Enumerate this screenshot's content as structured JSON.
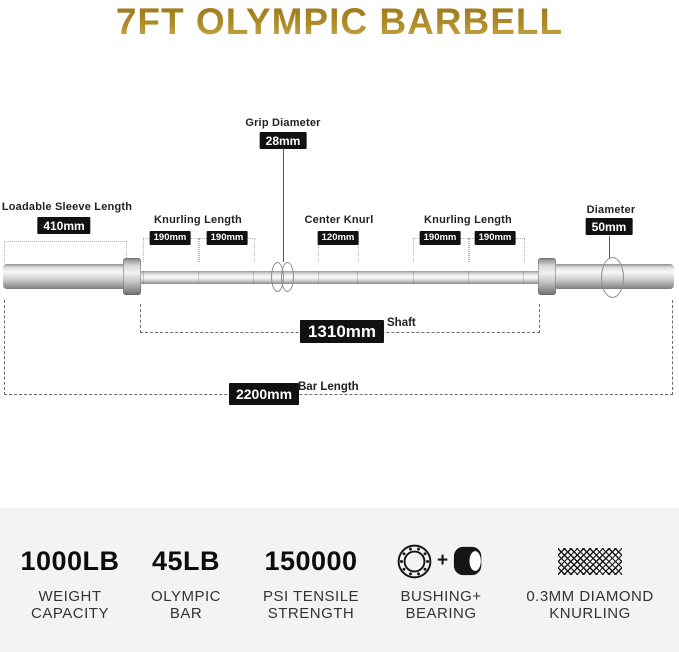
{
  "title": "7FT OLYMPIC BARBELL",
  "colors": {
    "title_gold_top": "#96751b",
    "title_gold_bottom": "#cfae52",
    "badge_bg": "#111111",
    "badge_text": "#ffffff",
    "specs_bg": "#f3f3f3",
    "label_text": "#333333",
    "barbell_silver": "#d9d9d9"
  },
  "diagram": {
    "grip": {
      "label": "Grip Diameter",
      "value": "28mm"
    },
    "loadable_sleeve": {
      "label": "Loadable Sleeve Length",
      "value": "410mm"
    },
    "knurling_left": {
      "label": "Knurling Length",
      "values": [
        "190mm",
        "190mm"
      ]
    },
    "center_knurl": {
      "label": "Center Knurl",
      "value": "120mm"
    },
    "knurling_right": {
      "label": "Knurling Length",
      "values": [
        "190mm",
        "190mm"
      ]
    },
    "diameter": {
      "label": "Diameter",
      "value": "50mm"
    },
    "shaft": {
      "label": "Shaft",
      "value": "1310mm"
    },
    "bar_length": {
      "label": "Bar Length",
      "value": "2200mm"
    }
  },
  "specs": {
    "items": [
      {
        "value": "1000LB",
        "label_lines": [
          "WEIGHT",
          "CAPACITY"
        ]
      },
      {
        "value": "45LB",
        "label_lines": [
          "OLYMPIC",
          "BAR"
        ]
      },
      {
        "value": "150000",
        "label_lines": [
          "PSI TENSILE",
          "STRENGTH"
        ]
      },
      {
        "icon": "bearing-ring-icon + bushing-cylinder-icon",
        "plus_glyph": "+",
        "label_lines": [
          "BUSHING+",
          "BEARING"
        ]
      },
      {
        "icon": "diamond-knurl-pattern",
        "label_lines": [
          "0.3MM DIAMOND",
          "KNURLING"
        ]
      }
    ]
  }
}
